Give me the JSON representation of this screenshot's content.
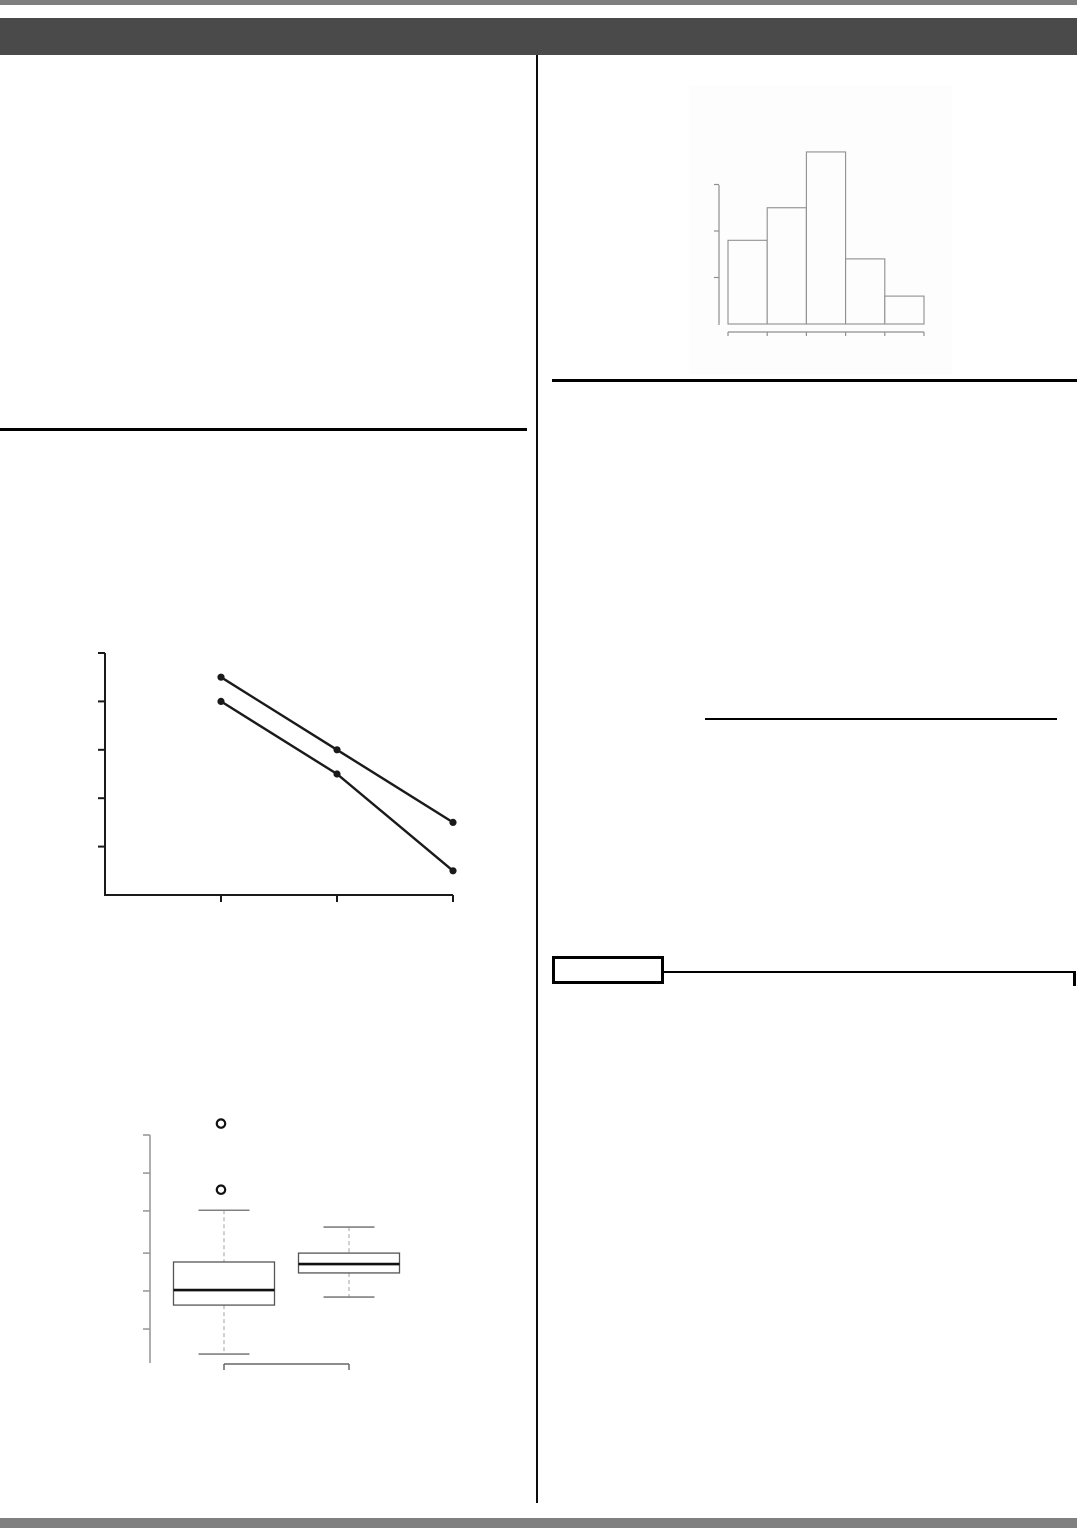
{
  "page": {
    "background": "#ffffff",
    "top_strip_color": "#7f7f7f",
    "header_bar_color": "#4a4a4a",
    "bottom_bar_color": "#808080",
    "divider_color": "#0d0d0d",
    "rule_color": "#000000",
    "underline_color": "#000000",
    "connector_color": "#000000"
  },
  "chart_data": [
    {
      "id": "histogram",
      "type": "bar",
      "title": "",
      "xlabel": "",
      "ylabel": "",
      "categories": [
        "",
        "",
        "",
        "",
        ""
      ],
      "values": [
        9,
        12.5,
        18.5,
        7,
        3
      ],
      "yticks": [
        5,
        10,
        15
      ],
      "ylim": [
        0,
        21
      ],
      "axis_labels_visible": false,
      "legend": "none",
      "grid": false,
      "stroke_color": "#8f8f8f",
      "bar_fill": "#fdfdfd",
      "background": "#fdfdfd"
    },
    {
      "id": "two-series-line",
      "type": "line",
      "title": "",
      "xlabel": "",
      "ylabel": "",
      "x": [
        1,
        2,
        3
      ],
      "series": [
        {
          "name": "series-1",
          "values": [
            4.5,
            3.0,
            1.5
          ]
        },
        {
          "name": "series-2",
          "values": [
            4.0,
            2.5,
            0.5
          ]
        }
      ],
      "xticks": [
        1,
        2,
        3
      ],
      "yticks": [
        1,
        2,
        3,
        4,
        5
      ],
      "xlim": [
        0,
        3
      ],
      "ylim": [
        0,
        5.3
      ],
      "axis_labels_visible": false,
      "legend": "none",
      "grid": false,
      "stroke_color": "#1a1a1a",
      "marker": "filled-circle"
    },
    {
      "id": "boxplot-pair",
      "type": "boxplot",
      "title": "",
      "xlabel": "",
      "ylabel": "",
      "orientation": "vertical",
      "yticks": [
        1.49,
        3.16,
        4.82,
        6.67,
        8.33,
        10.0
      ],
      "ylim": [
        0,
        10.6
      ],
      "axis_labels_visible": false,
      "grid": false,
      "groups": [
        {
          "name": "group-1",
          "whisker_low": 0.39,
          "q1": 2.54,
          "median": 3.2,
          "q3": 4.43,
          "whisker_high": 6.7,
          "outliers": [
            7.6,
            10.5
          ]
        },
        {
          "name": "group-2",
          "whisker_low": 2.89,
          "q1": 3.95,
          "median": 4.34,
          "q3": 4.82,
          "whisker_high": 5.96,
          "outliers": []
        }
      ],
      "box_stroke": "#555555",
      "median_stroke": "#111111",
      "whisker_stroke": "#bdbdbd",
      "cap_stroke": "#808080",
      "axis_stroke": "#9a9a9a",
      "bracket_stroke": "#666666"
    }
  ]
}
